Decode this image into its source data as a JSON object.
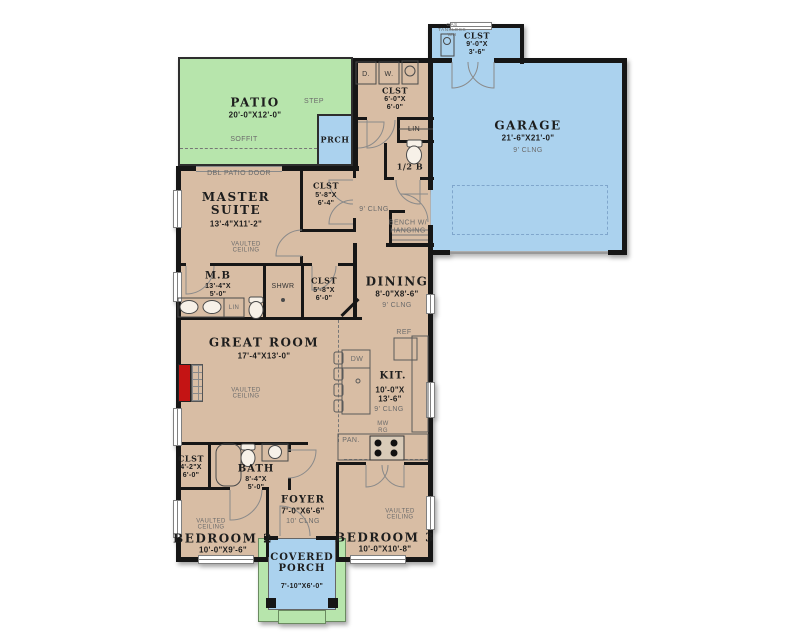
{
  "colors": {
    "interior": "#d8bda4",
    "patio_green": "#b7e5ac",
    "garage_blue": "#abd2ee",
    "wall": "#161616",
    "fireplace_red": "#c41414"
  },
  "rooms": {
    "patio": {
      "name": "PATIO",
      "dims": "20'-0\"X12'-0\""
    },
    "prch": {
      "name": "PRCH"
    },
    "garage_clst": {
      "name": "CLST",
      "dim1": "9'-0\"X",
      "dim2": "3'-6\""
    },
    "garage": {
      "name": "GARAGE",
      "dims": "21'-6\"X21'-0\"",
      "clng": "9' CLNG"
    },
    "laundry_clst": {
      "name": "CLST",
      "dim1": "6'-0\"X",
      "dim2": "6'-0\""
    },
    "half_bath": {
      "name": "1/2 B"
    },
    "hall_clst": {
      "name": "CLST",
      "dim1": "5'-8\"X",
      "dim2": "6'-4\""
    },
    "master": {
      "name": "MASTER SUITE",
      "dims": "13'-4\"X11'-2\""
    },
    "mb": {
      "name": "M.B",
      "dim1": "13'-4\"X",
      "dim2": "5'-0\""
    },
    "shwr": {
      "name": "SHWR"
    },
    "master_clst": {
      "name": "CLST",
      "dim1": "5'-8\"X",
      "dim2": "6'-0\""
    },
    "dining": {
      "name": "DINING",
      "dims": "8'-0\"X8'-6\"",
      "clng": "9' CLNG"
    },
    "great": {
      "name": "GREAT ROOM",
      "dims": "17'-4\"X13'-0\""
    },
    "kit": {
      "name": "KIT.",
      "dim1": "10'-0\"X",
      "dim2": "13'-6\"",
      "clng": "9' CLNG"
    },
    "bed2_clst": {
      "name": "CLST",
      "dim1": "4'-2\"X",
      "dim2": "6'-0\""
    },
    "bath": {
      "name": "BATH",
      "dim1": "8'-4\"X",
      "dim2": "5'-0\""
    },
    "foyer": {
      "name": "FOYER",
      "dims": "7'-0\"X6'-6\"",
      "clng": "10' CLNG"
    },
    "bed2": {
      "name": "BEDROOM 2",
      "dims": "10'-0\"X9'-6\""
    },
    "bed3": {
      "name": "BEDROOM 3",
      "dims": "10'-0\"X10'-8\""
    },
    "porch": {
      "name": "COVERED PORCH",
      "dims": "7'-10\"X6'-0\""
    }
  },
  "labels": {
    "step": "STEP",
    "soffit": "SOFFIT",
    "dbl_patio_door": "DBL PATIO DOOR",
    "gas_wh": "GAS TANKLESS WH",
    "dryer": "D.",
    "washer": "W.",
    "lin": "LIN",
    "bench": "BENCH W/ HANGING",
    "vaulted": "VAULTED CEILING",
    "clng9": "9' CLNG",
    "ref": "REF",
    "dw": "DW",
    "pan": "PAN.",
    "mw": "MW",
    "rg": "RG"
  }
}
